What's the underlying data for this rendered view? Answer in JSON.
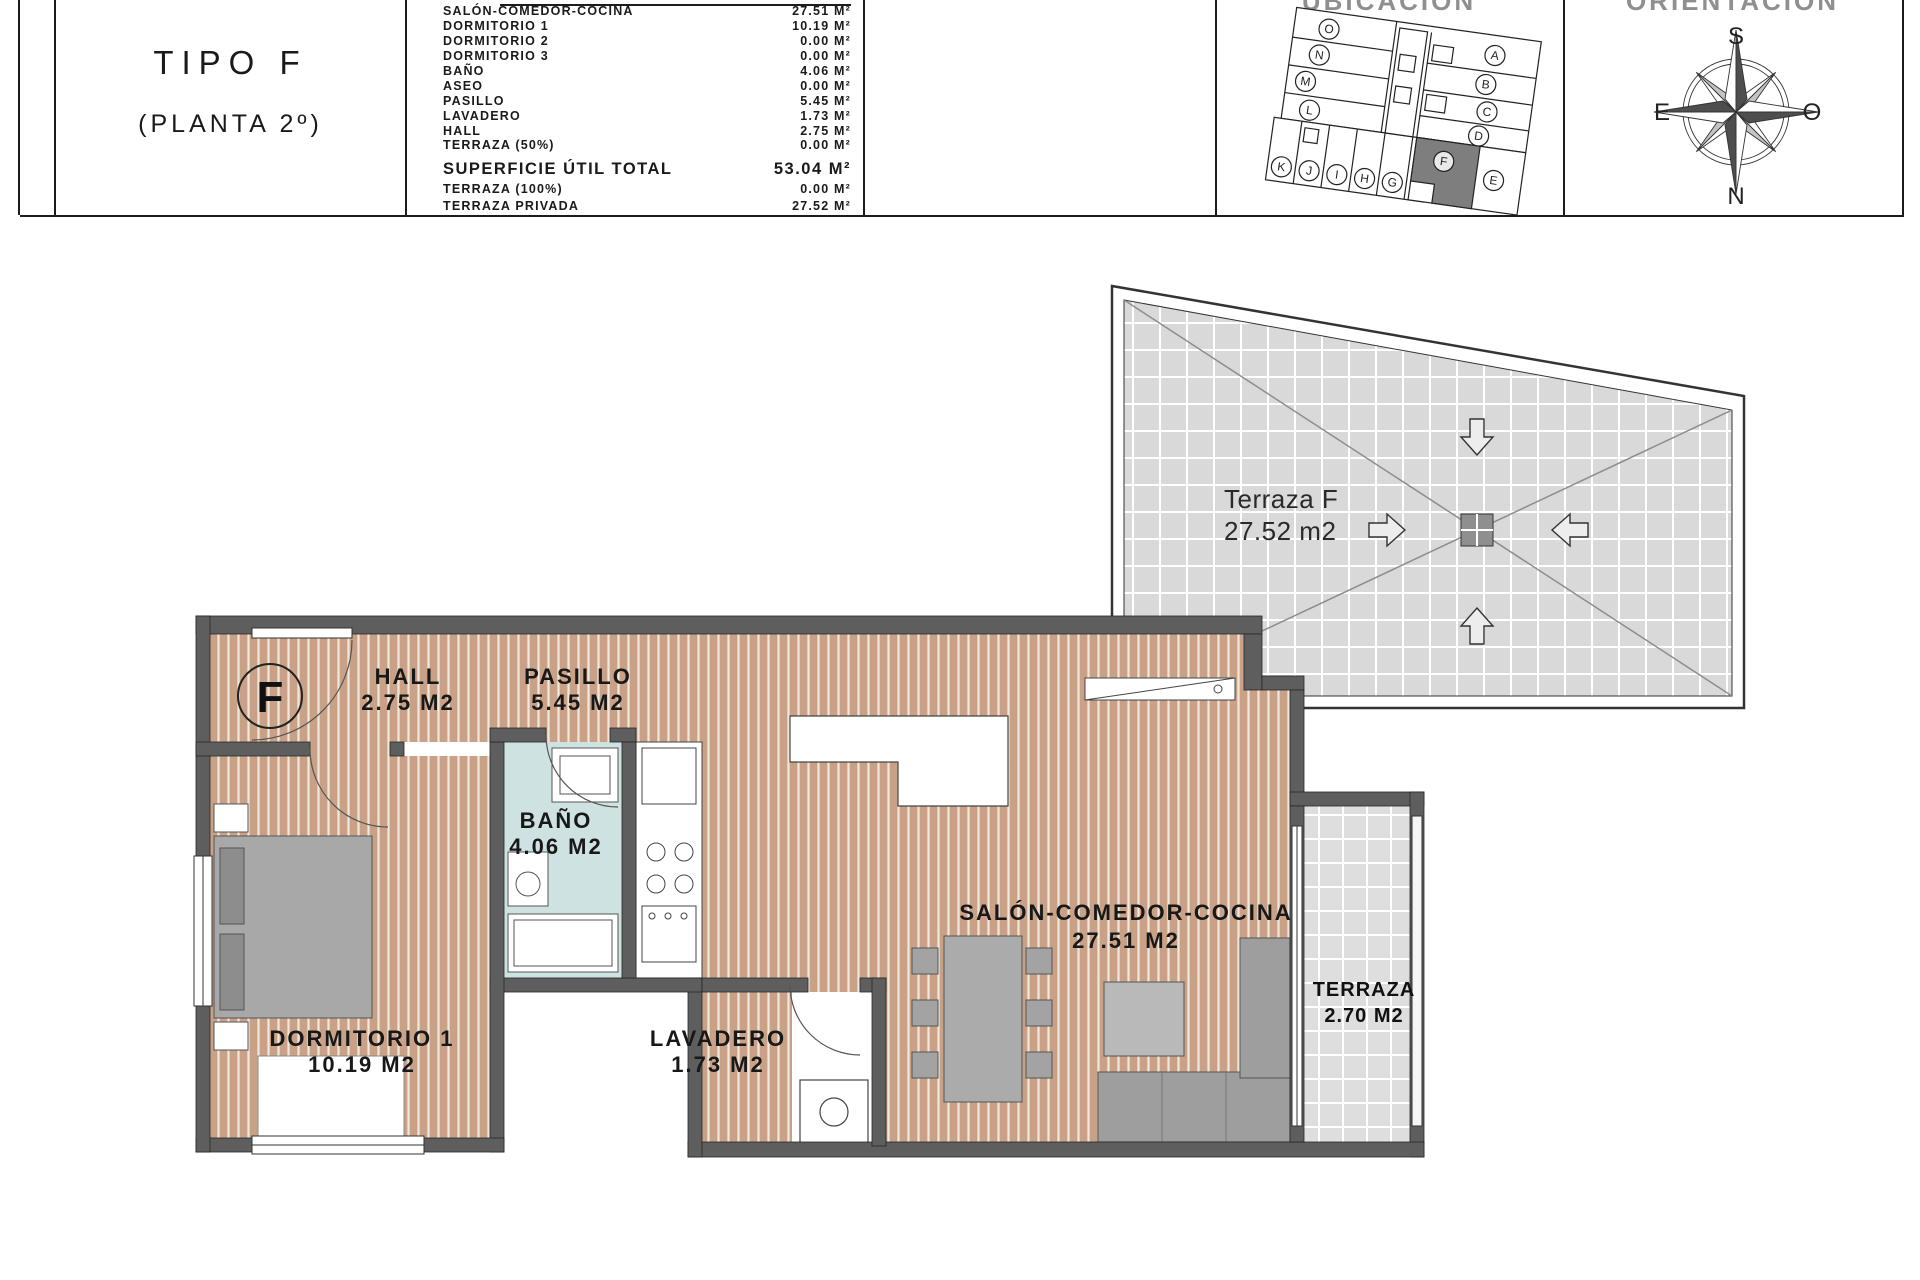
{
  "header": {
    "type_title": "TIPO F",
    "type_subtitle": "(PLANTA 2º)",
    "ubicacion_title": "UBICACIÓN",
    "orientacion_title": "ORIENTACIÓN",
    "areas_table": {
      "rows": [
        {
          "label": "SALÓN-COMEDOR-COCINA",
          "value": "27.51 M²"
        },
        {
          "label": "DORMITORIO 1",
          "value": "10.19 M²"
        },
        {
          "label": "DORMITORIO 2",
          "value": "0.00 M²"
        },
        {
          "label": "DORMITORIO 3",
          "value": "0.00 M²"
        },
        {
          "label": "BAÑO",
          "value": "4.06 M²"
        },
        {
          "label": "ASEO",
          "value": "0.00 M²"
        },
        {
          "label": "PASILLO",
          "value": "5.45 M²"
        },
        {
          "label": "LAVADERO",
          "value": "1.73 M²"
        },
        {
          "label": "HALL",
          "value": "2.75 M²"
        },
        {
          "label": "TERRAZA (50%)",
          "value": "0.00 M²"
        }
      ],
      "total": {
        "label": "SUPERFICIE ÚTIL TOTAL",
        "value": "53.04 M²"
      },
      "extra": [
        {
          "label": "TERRAZA (100%)",
          "value": "0.00 M²"
        },
        {
          "label": "TERRAZA PRIVADA",
          "value": "27.52 M²"
        }
      ]
    }
  },
  "site_plan": {
    "units": [
      "O",
      "N",
      "M",
      "L",
      "A",
      "B",
      "C",
      "D",
      "K",
      "J",
      "I",
      "H",
      "G",
      "F",
      "E"
    ],
    "highlighted_unit": "F"
  },
  "compass": {
    "top": "S",
    "bottom": "N",
    "left": "E",
    "right": "O"
  },
  "floor_plan": {
    "unit_letter": "F",
    "rooms": [
      {
        "name": "HALL",
        "area": "2.75 M2"
      },
      {
        "name": "PASILLO",
        "area": "5.45 M2"
      },
      {
        "name": "BAÑO",
        "area": "4.06 M2"
      },
      {
        "name": "DORMITORIO 1",
        "area": "10.19 M2"
      },
      {
        "name": "LAVADERO",
        "area": "1.73 M2"
      },
      {
        "name": "SALÓN-COMEDOR-COCINA",
        "area": "27.51 M2"
      },
      {
        "name": "TERRAZA",
        "area": "2.70 M2"
      }
    ]
  },
  "terrace_plan": {
    "name": "Terraza F",
    "area": "27.52 m2"
  },
  "colors": {
    "wood_floor": "#c8a186",
    "bath_floor": "#cde2e1",
    "wall": "#5e5e5e",
    "tile_floor": "#d9d9d9",
    "highlighted_unit_fill": "#7e7e7e"
  }
}
